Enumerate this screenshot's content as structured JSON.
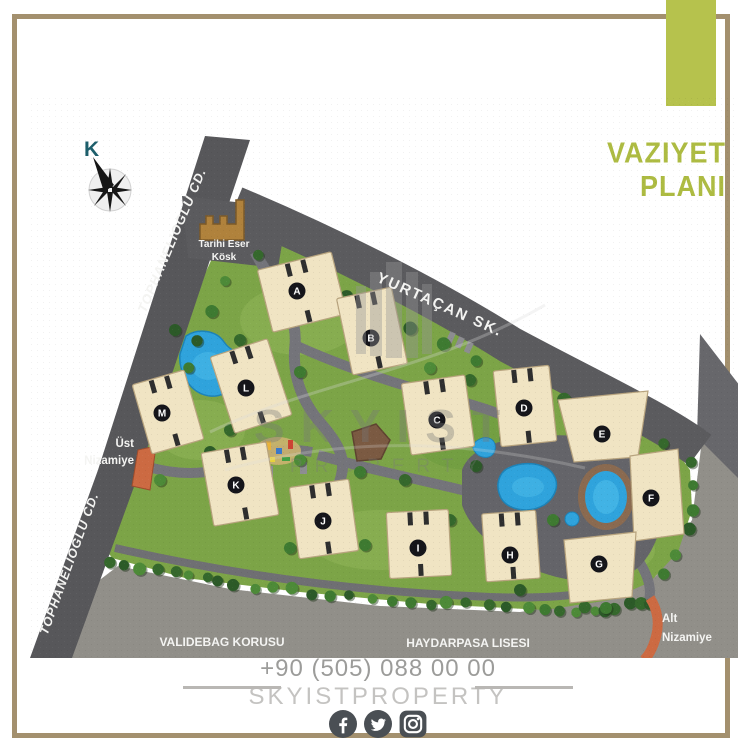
{
  "title": {
    "line1": "VAZIYET",
    "line2": "PLANI",
    "color": "#adbb42"
  },
  "compass": {
    "label": "K"
  },
  "map": {
    "street_labels": {
      "tophanelioglu_upper": "TOPHANELIOGLU CD.",
      "tophanelioglu_lower": "TOPHANELIOGLU CD.",
      "yurtacan": "YURTAÇAN SK."
    },
    "area_labels": {
      "validebag": "VALIDEBAG KORUSU",
      "haydarpasa": "HAYDARPASA LISESI"
    },
    "landmark": {
      "line1": "Tarihi Eser",
      "line2": "Kösk"
    },
    "gates": {
      "ust": {
        "line1": "Üst",
        "line2": "Nizamiye"
      },
      "alt": {
        "line1": "Alt",
        "line2": "Nizamiye"
      }
    },
    "buildings": [
      {
        "letter": "A",
        "x": 297,
        "y": 291
      },
      {
        "letter": "B",
        "x": 371,
        "y": 338
      },
      {
        "letter": "C",
        "x": 437,
        "y": 420
      },
      {
        "letter": "D",
        "x": 524,
        "y": 408
      },
      {
        "letter": "E",
        "x": 602,
        "y": 434
      },
      {
        "letter": "F",
        "x": 651,
        "y": 498
      },
      {
        "letter": "G",
        "x": 599,
        "y": 564
      },
      {
        "letter": "H",
        "x": 510,
        "y": 555
      },
      {
        "letter": "I",
        "x": 418,
        "y": 548
      },
      {
        "letter": "J",
        "x": 323,
        "y": 521
      },
      {
        "letter": "K",
        "x": 236,
        "y": 485
      },
      {
        "letter": "L",
        "x": 246,
        "y": 388
      },
      {
        "letter": "M",
        "x": 162,
        "y": 413
      }
    ]
  },
  "watermark": {
    "line1": "SKYIST",
    "line2": "PROPERTY"
  },
  "footer": {
    "phone": "+90 (505) 088 00 00",
    "brand": "SKYISTPROPERTY",
    "social": [
      "facebook-icon",
      "twitter-icon",
      "instagram-icon"
    ]
  },
  "colors": {
    "accent_green": "#b6c24d",
    "frame_tan": "#a3906e",
    "road_dark": "#5b5b5e",
    "outside_gray": "#918f89",
    "site_green": "#7ca447",
    "building_cream": "#f0e4c3",
    "pool_blue": "#2fa3dc",
    "gate_orange": "#cc6a42"
  }
}
